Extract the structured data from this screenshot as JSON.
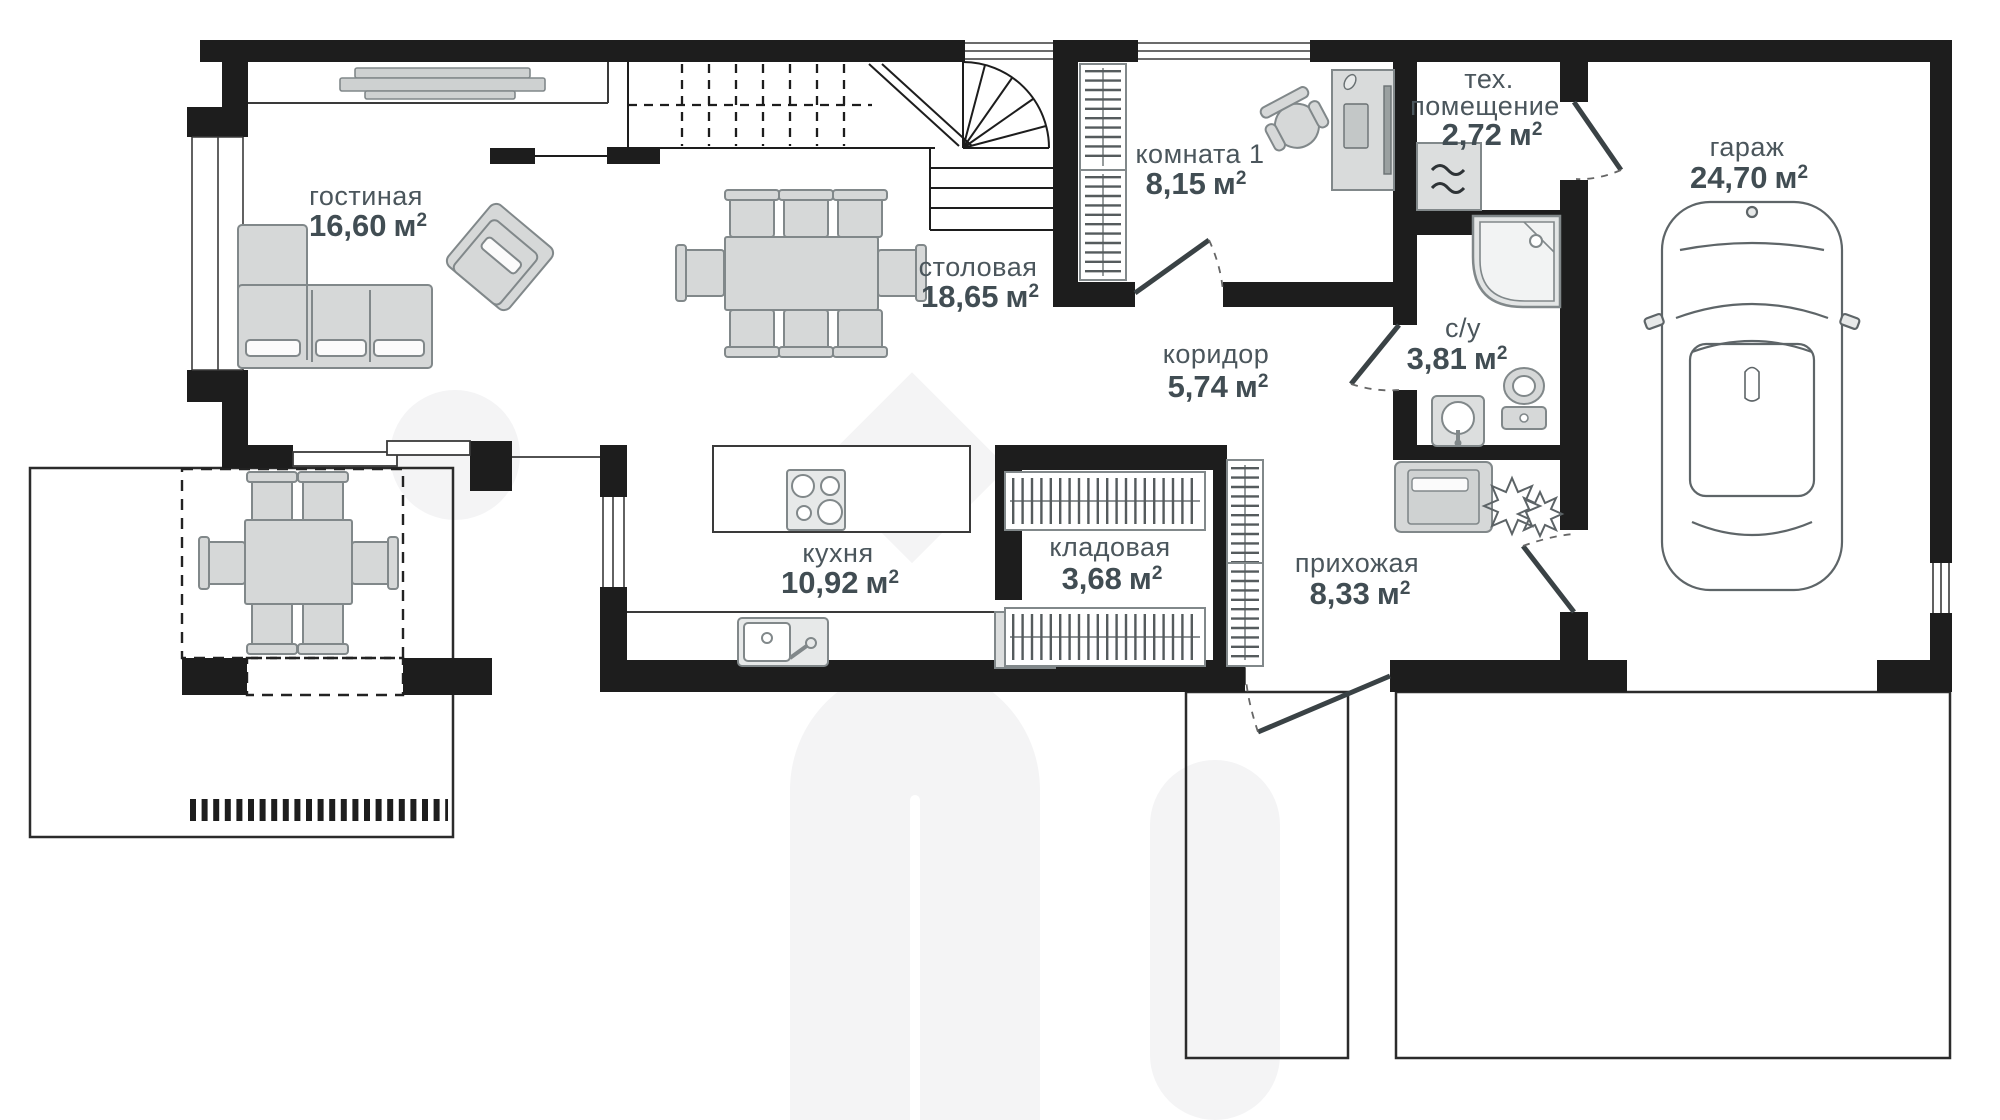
{
  "plan": {
    "type": "floor-plan",
    "language": "ru",
    "rooms": [
      {
        "id": "living",
        "name": "гостиная",
        "area": "16,60"
      },
      {
        "id": "dining",
        "name": "столовая",
        "area": "18,65"
      },
      {
        "id": "room1",
        "name": "комната 1",
        "area": "8,15"
      },
      {
        "id": "tech",
        "name": "тех. помещение",
        "name_line1": "тех.",
        "name_line2": "помещение",
        "area": "2,72"
      },
      {
        "id": "garage",
        "name": "гараж",
        "area": "24,70"
      },
      {
        "id": "corridor",
        "name": "коридор",
        "area": "5,74"
      },
      {
        "id": "bath",
        "name": "с/у",
        "area": "3,81"
      },
      {
        "id": "kitchen",
        "name": "кухня",
        "area": "10,92"
      },
      {
        "id": "storage",
        "name": "кладовая",
        "area": "3,68"
      },
      {
        "id": "hall",
        "name": "прихожая",
        "area": "8,33"
      }
    ],
    "units": {
      "area_unit": "м",
      "area_sup": "2"
    },
    "colors": {
      "wall": "#1d1d1d",
      "furniture_fill": "#d6d8d8",
      "furniture_stroke": "#81888a",
      "label_text": "#4b565c",
      "watermark": "#f4f4f5"
    }
  }
}
